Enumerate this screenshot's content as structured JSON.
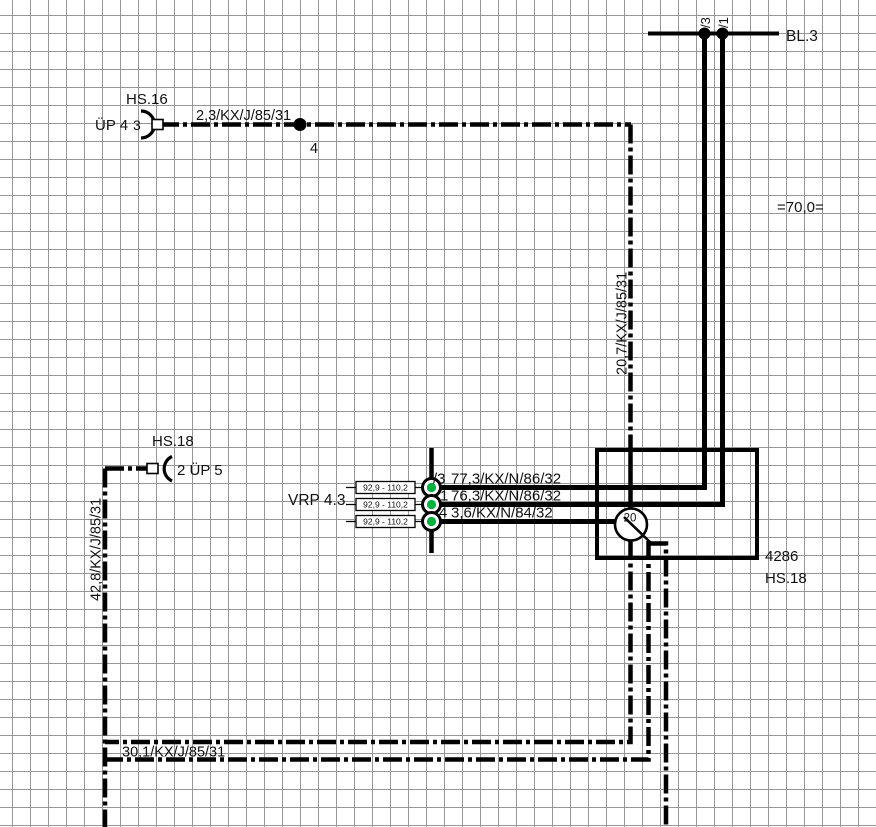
{
  "diagram": {
    "colors": {
      "line": "#000000",
      "grid": "#979797",
      "text": "#111111",
      "pin_green": "#00b13e"
    },
    "hs16_branch": {
      "component": "HS.16",
      "connector": "ÜP 4",
      "pin": "3",
      "wire_label": "2,3/KX/J/85/31",
      "junction_label": "4"
    },
    "bl3_bus": {
      "label": "BL.3",
      "pin_left": "/3",
      "pin_right": "/1"
    },
    "dimension_label": "=70,0=",
    "riser_label": "20,7/KX/J/85/31",
    "hs18_branch": {
      "component": "HS.18",
      "connector": "2 ÜP 5",
      "riser_label": "42,8/KX/J/85/31"
    },
    "vrp": {
      "label": "VRP 4.3",
      "rows": [
        {
          "pin": "/3",
          "wire": "77,3/KX/N/86/32",
          "range": "92,9 - 110,2"
        },
        {
          "pin": "1",
          "wire": "76,3/KX/N/86/32",
          "range": "92,9 - 110,2"
        },
        {
          "pin": "4",
          "wire": "3,6/KX/N/84/32",
          "range": "92,9 - 110,2"
        }
      ]
    },
    "module": {
      "code": "4286",
      "component": "HS.18",
      "pass_through": "20"
    },
    "bottom_wire_label": "30,1/KX/J/85/31"
  }
}
